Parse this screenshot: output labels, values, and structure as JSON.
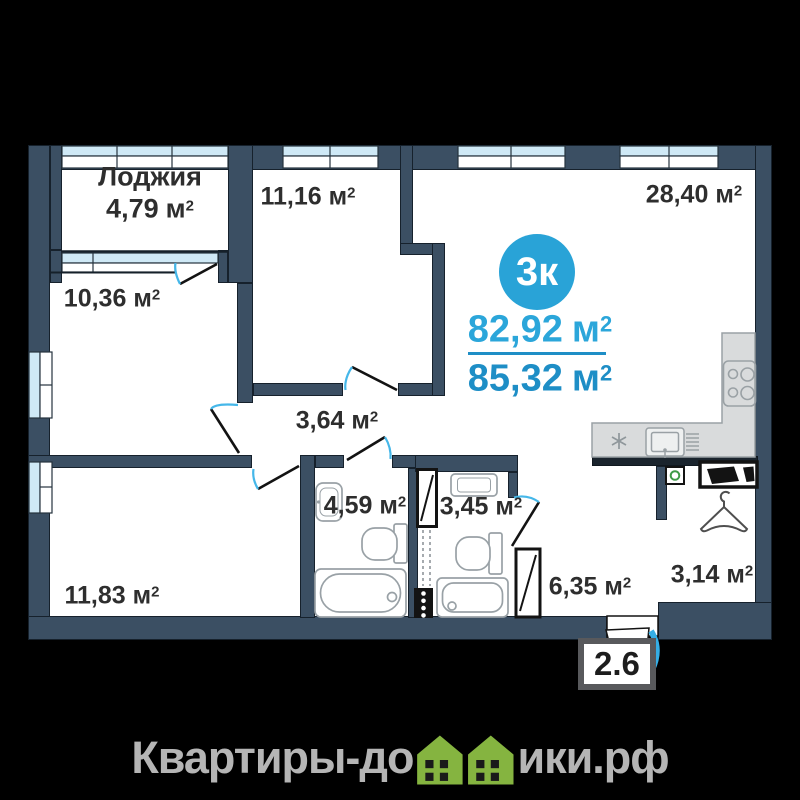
{
  "plan": {
    "badge": {
      "label": "3к"
    },
    "areas_summary": {
      "living": {
        "value": "82,92",
        "unit": "м",
        "sup": "2"
      },
      "total": {
        "value": "85,32",
        "unit": "м",
        "sup": "2"
      }
    },
    "rooms": [
      {
        "id": "loggia",
        "name": "Лоджия",
        "value": "4,79",
        "unit": "м",
        "sup": "2"
      },
      {
        "id": "bedroom-top",
        "value": "11,16",
        "unit": "м",
        "sup": "2"
      },
      {
        "id": "kitchen-living",
        "value": "28,40",
        "unit": "м",
        "sup": "2"
      },
      {
        "id": "bedroom-left",
        "value": "10,36",
        "unit": "м",
        "sup": "2"
      },
      {
        "id": "corridor",
        "value": "3,64",
        "unit": "м",
        "sup": "2"
      },
      {
        "id": "bathroom",
        "value": "4,59",
        "unit": "м",
        "sup": "2"
      },
      {
        "id": "toilet",
        "value": "3,45",
        "unit": "м",
        "sup": "2"
      },
      {
        "id": "bedroom-bottom",
        "value": "11,83",
        "unit": "м",
        "sup": "2"
      },
      {
        "id": "hall",
        "value": "6,35",
        "unit": "м",
        "sup": "2"
      },
      {
        "id": "entry",
        "value": "3,14",
        "unit": "м",
        "sup": "2"
      }
    ],
    "entrance_width_label": "2.6"
  },
  "watermark": {
    "prefix": "Квартиры-до",
    "suffix": "ики.рф"
  },
  "colors": {
    "wall_navy": "#3b4f63",
    "accent_blue": "#29a3d7",
    "area_text_blue_top": "#2ba6da",
    "area_text_blue_bottom": "#1e8ec6",
    "door_arc_blue": "#45b7e9",
    "window_glass": "#cfe9f6",
    "vent_green": "#3f9b48",
    "logo_green": "#85b440",
    "watermark_gray": "#b5b5b5"
  },
  "icons": {
    "fixtures": [
      "bathtub-icon",
      "toilet-icon",
      "sink-icon",
      "stove-icon",
      "kitchen-sink-icon",
      "fridge-asterisk-icon",
      "hanger-icon",
      "wardrobe-icon",
      "vent-icon",
      "shaft-icon",
      "house-icon"
    ]
  }
}
